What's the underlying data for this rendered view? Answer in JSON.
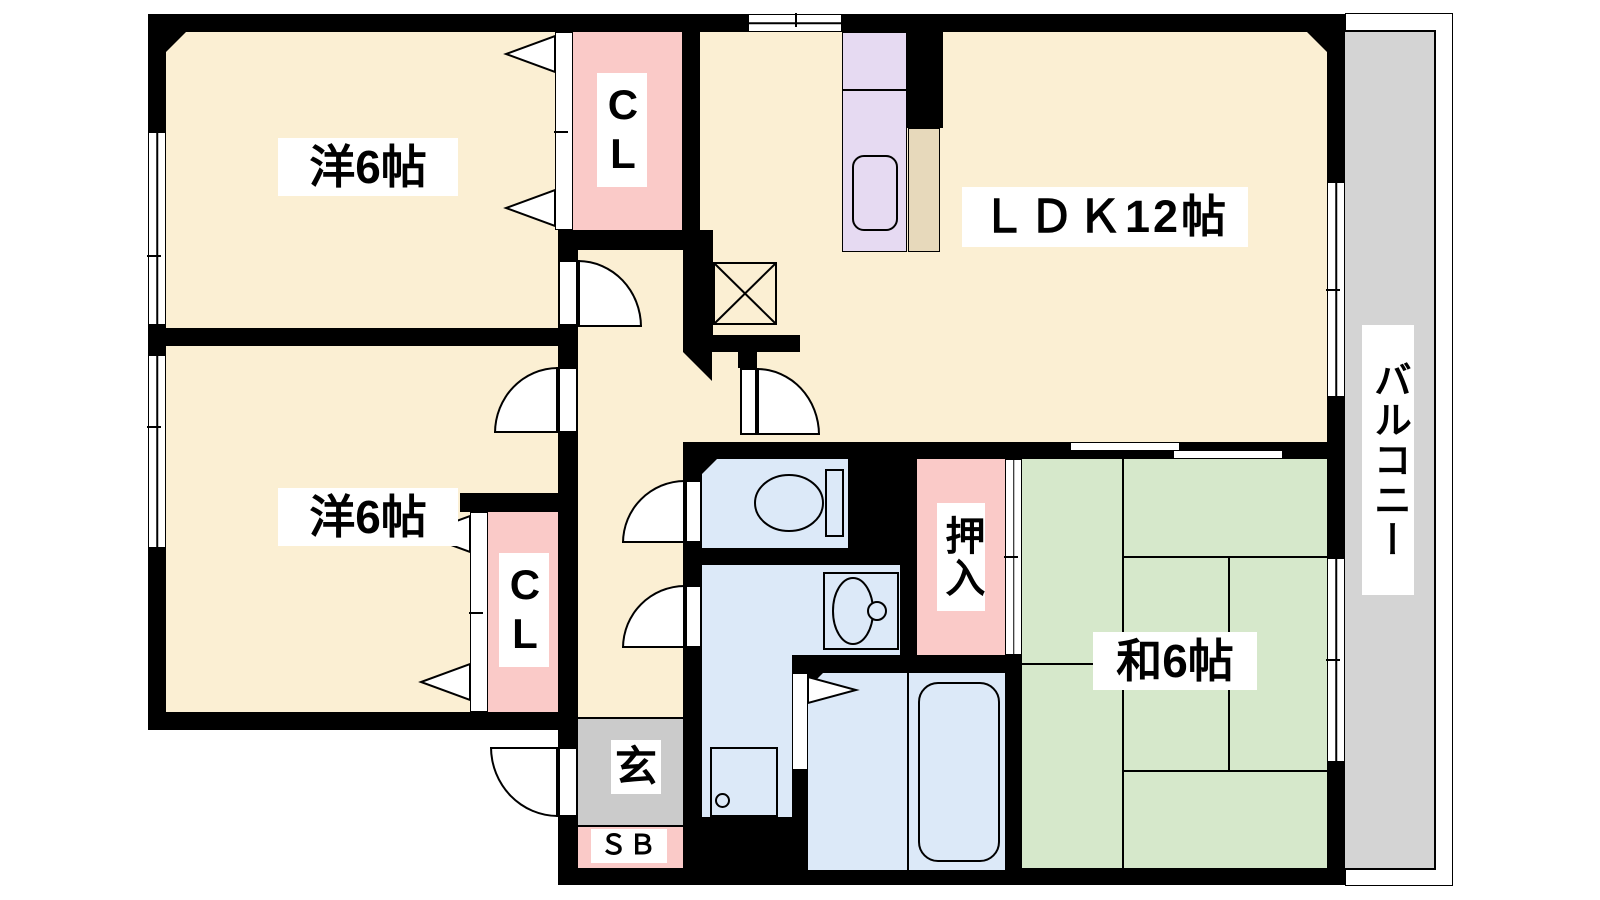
{
  "rooms": {
    "bedroom_top": {
      "label": "洋6帖"
    },
    "bedroom_bottom": {
      "label": "洋6帖"
    },
    "ldk": {
      "label": "ＬＤＫ12帖"
    },
    "japanese_room": {
      "label": "和6帖"
    },
    "closet_top": {
      "label": "CL"
    },
    "closet_bottom": {
      "label": "CL"
    },
    "oshiire": {
      "label": "押入"
    },
    "entrance": {
      "label": "玄"
    },
    "shoe_box": {
      "label": "ＳＢ"
    },
    "balcony": {
      "label": "バルコニー"
    }
  },
  "colors": {
    "wall_black": "#000000",
    "floor_cream": "#FBEFD3",
    "closet_pink": "#FACAC8",
    "tatami_green": "#D6E8CB",
    "water_blue": "#DCE9F8",
    "kitchen_lavender": "#E6DAF2",
    "appliance_tan": "#E7D9BB",
    "genkan_gray": "#CBCBCB",
    "balcony_gray": "#D4D4D4"
  }
}
